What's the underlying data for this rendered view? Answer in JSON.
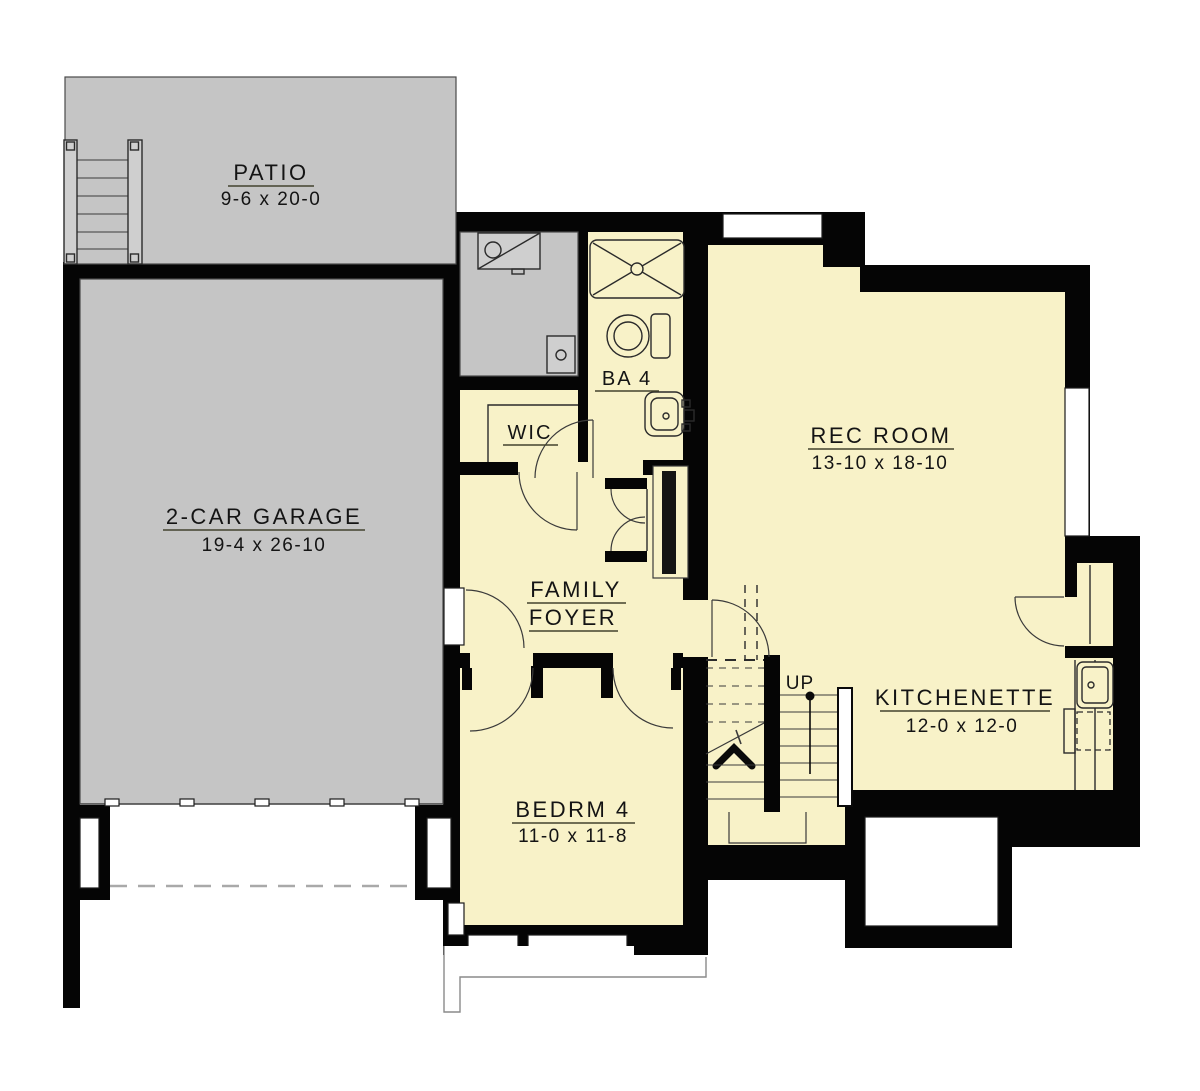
{
  "plan": {
    "title": "Basement floor plan",
    "rooms": {
      "patio": {
        "name": "PATIO",
        "dims": "9-6 x 20-0"
      },
      "garage": {
        "name": "2-CAR GARAGE",
        "dims": "19-4 x 26-10"
      },
      "rec_room": {
        "name": "REC ROOM",
        "dims": "13-10 x 18-10"
      },
      "kitchenette": {
        "name": "KITCHENETTE",
        "dims": "12-0 x 12-0"
      },
      "bedroom4": {
        "name": "BEDRM 4",
        "dims": "11-0 x 11-8"
      },
      "bath4": {
        "name": "BA 4"
      },
      "wic": {
        "name": "WIC"
      },
      "family_foyer": {
        "line1": "FAMILY",
        "line2": "FOYER"
      },
      "stairs": {
        "label": "UP"
      }
    },
    "colors": {
      "wall": "#050505",
      "room_fill": "#f8f2c8",
      "outdoor_fill": "#c5c5c5",
      "background": "#ffffff"
    }
  }
}
